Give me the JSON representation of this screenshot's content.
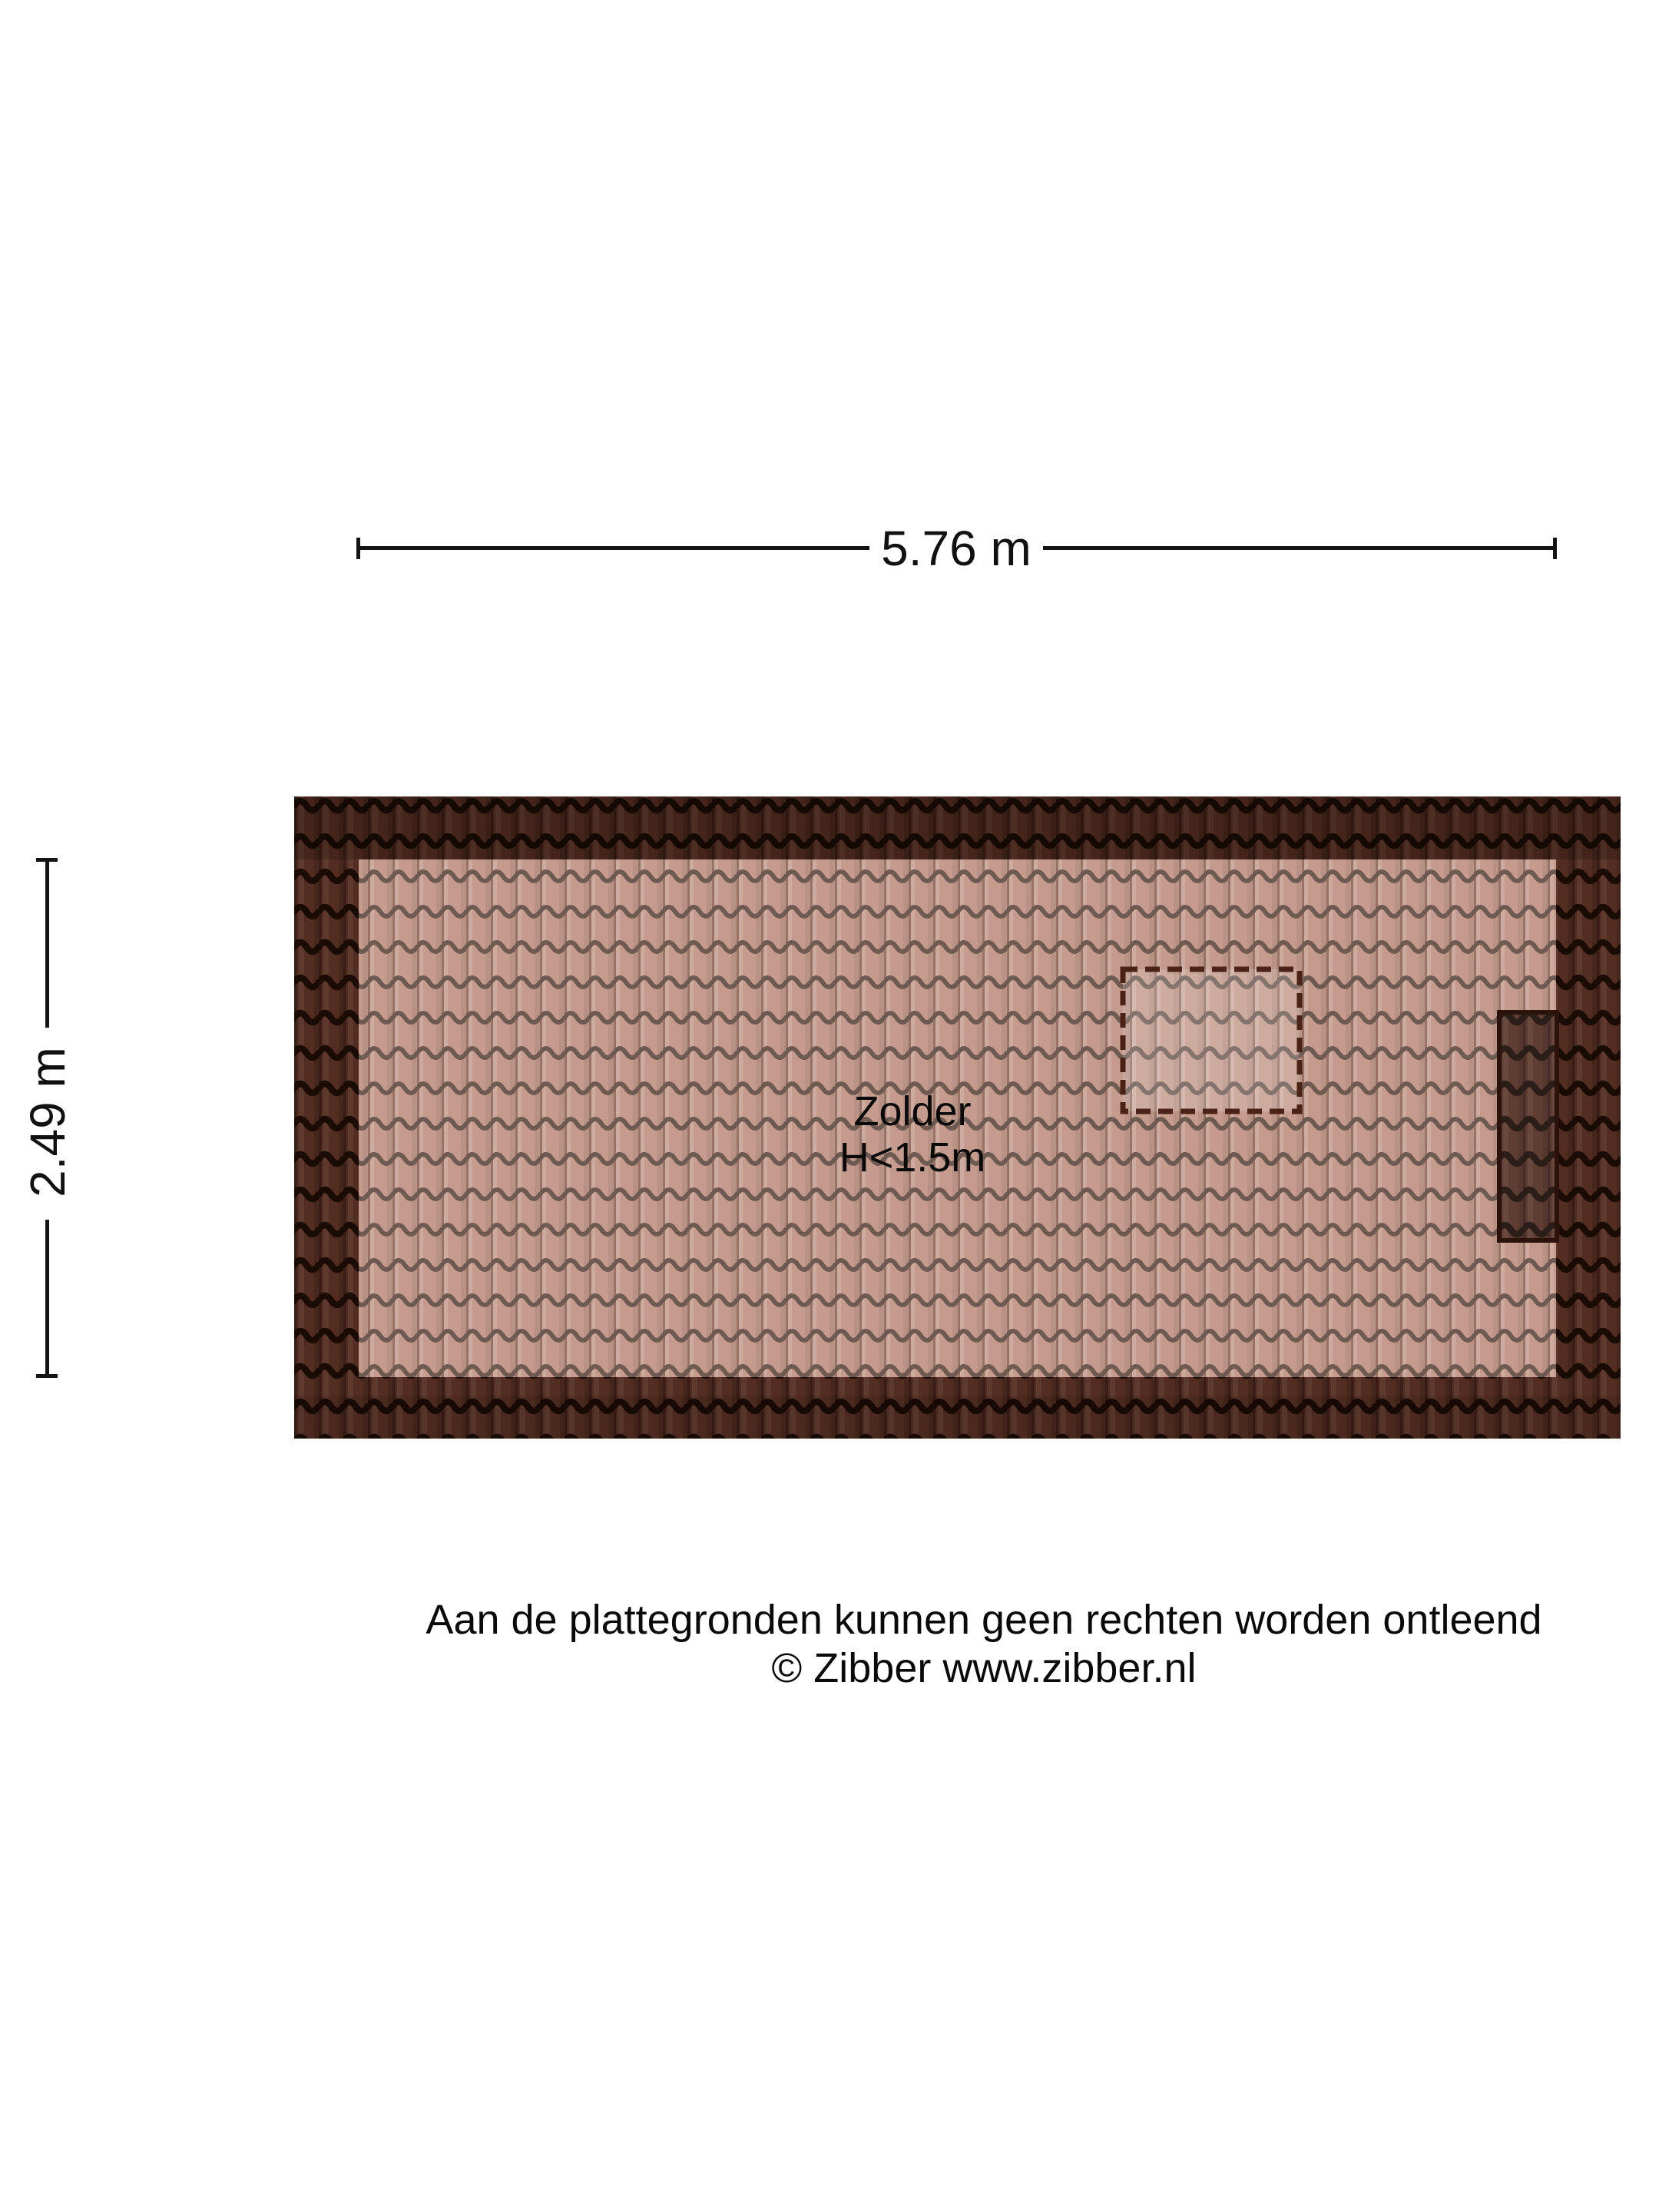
{
  "page": {
    "background": "#ffffff",
    "type_note": "attic roof floor plan"
  },
  "dimension_width": {
    "label": "5.76 m"
  },
  "dimension_height": {
    "label": "2.49 m"
  },
  "room": {
    "name": "Zolder",
    "height_note": "H<1.5m"
  },
  "footer": {
    "disclaimer": "Aan de plattegronden kunnen geen rechten worden ontleend",
    "copyright": "© Zibber www.zibber.nl"
  },
  "colors": {
    "dimension_line": "#141414",
    "text": "#0a0a0a",
    "roof_dark_base": "#532d21",
    "roof_dark_line": "#1a0b05",
    "roof_light_base": "#c49b8d",
    "roof_light_line": "#6e5a51",
    "recess_border": "#2b130b",
    "skylight_dash": "#4b2316"
  }
}
